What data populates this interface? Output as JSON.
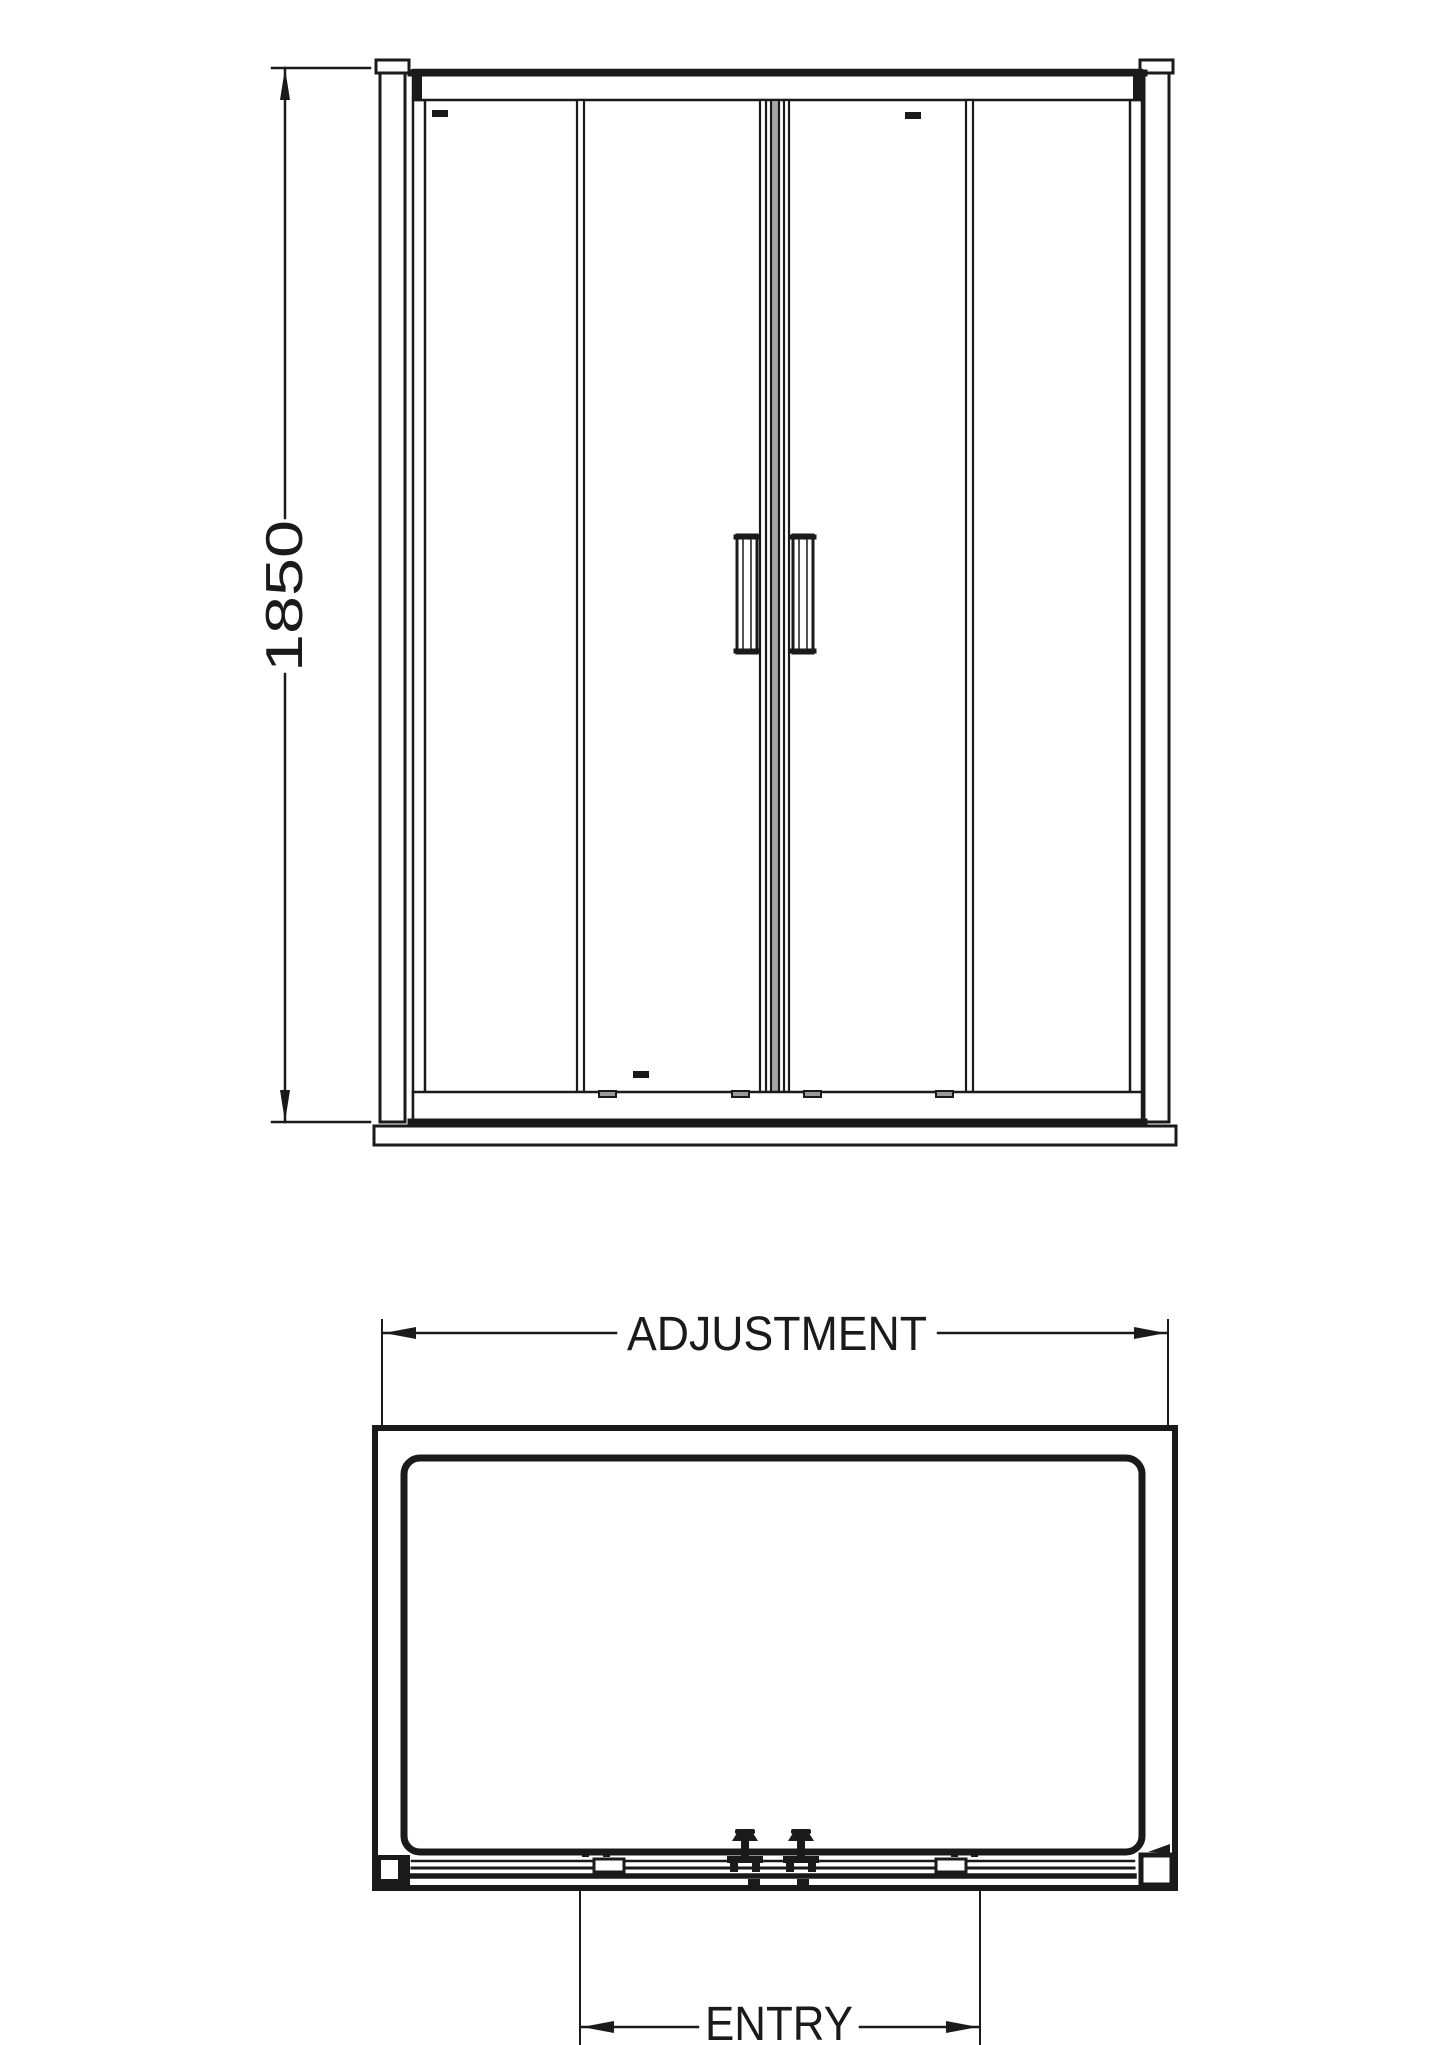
{
  "colors": {
    "line": "#1a1a1a",
    "background": "#ffffff",
    "glass_edge_gray": "#a6a6a6",
    "roller_gray": "#999999"
  },
  "front_elevation": {
    "height_dimension": {
      "label": "1850"
    }
  },
  "plan_view": {
    "width_dimension": {
      "label": "ADJUSTMENT"
    },
    "entry_dimension": {
      "label": "ENTRY"
    }
  }
}
